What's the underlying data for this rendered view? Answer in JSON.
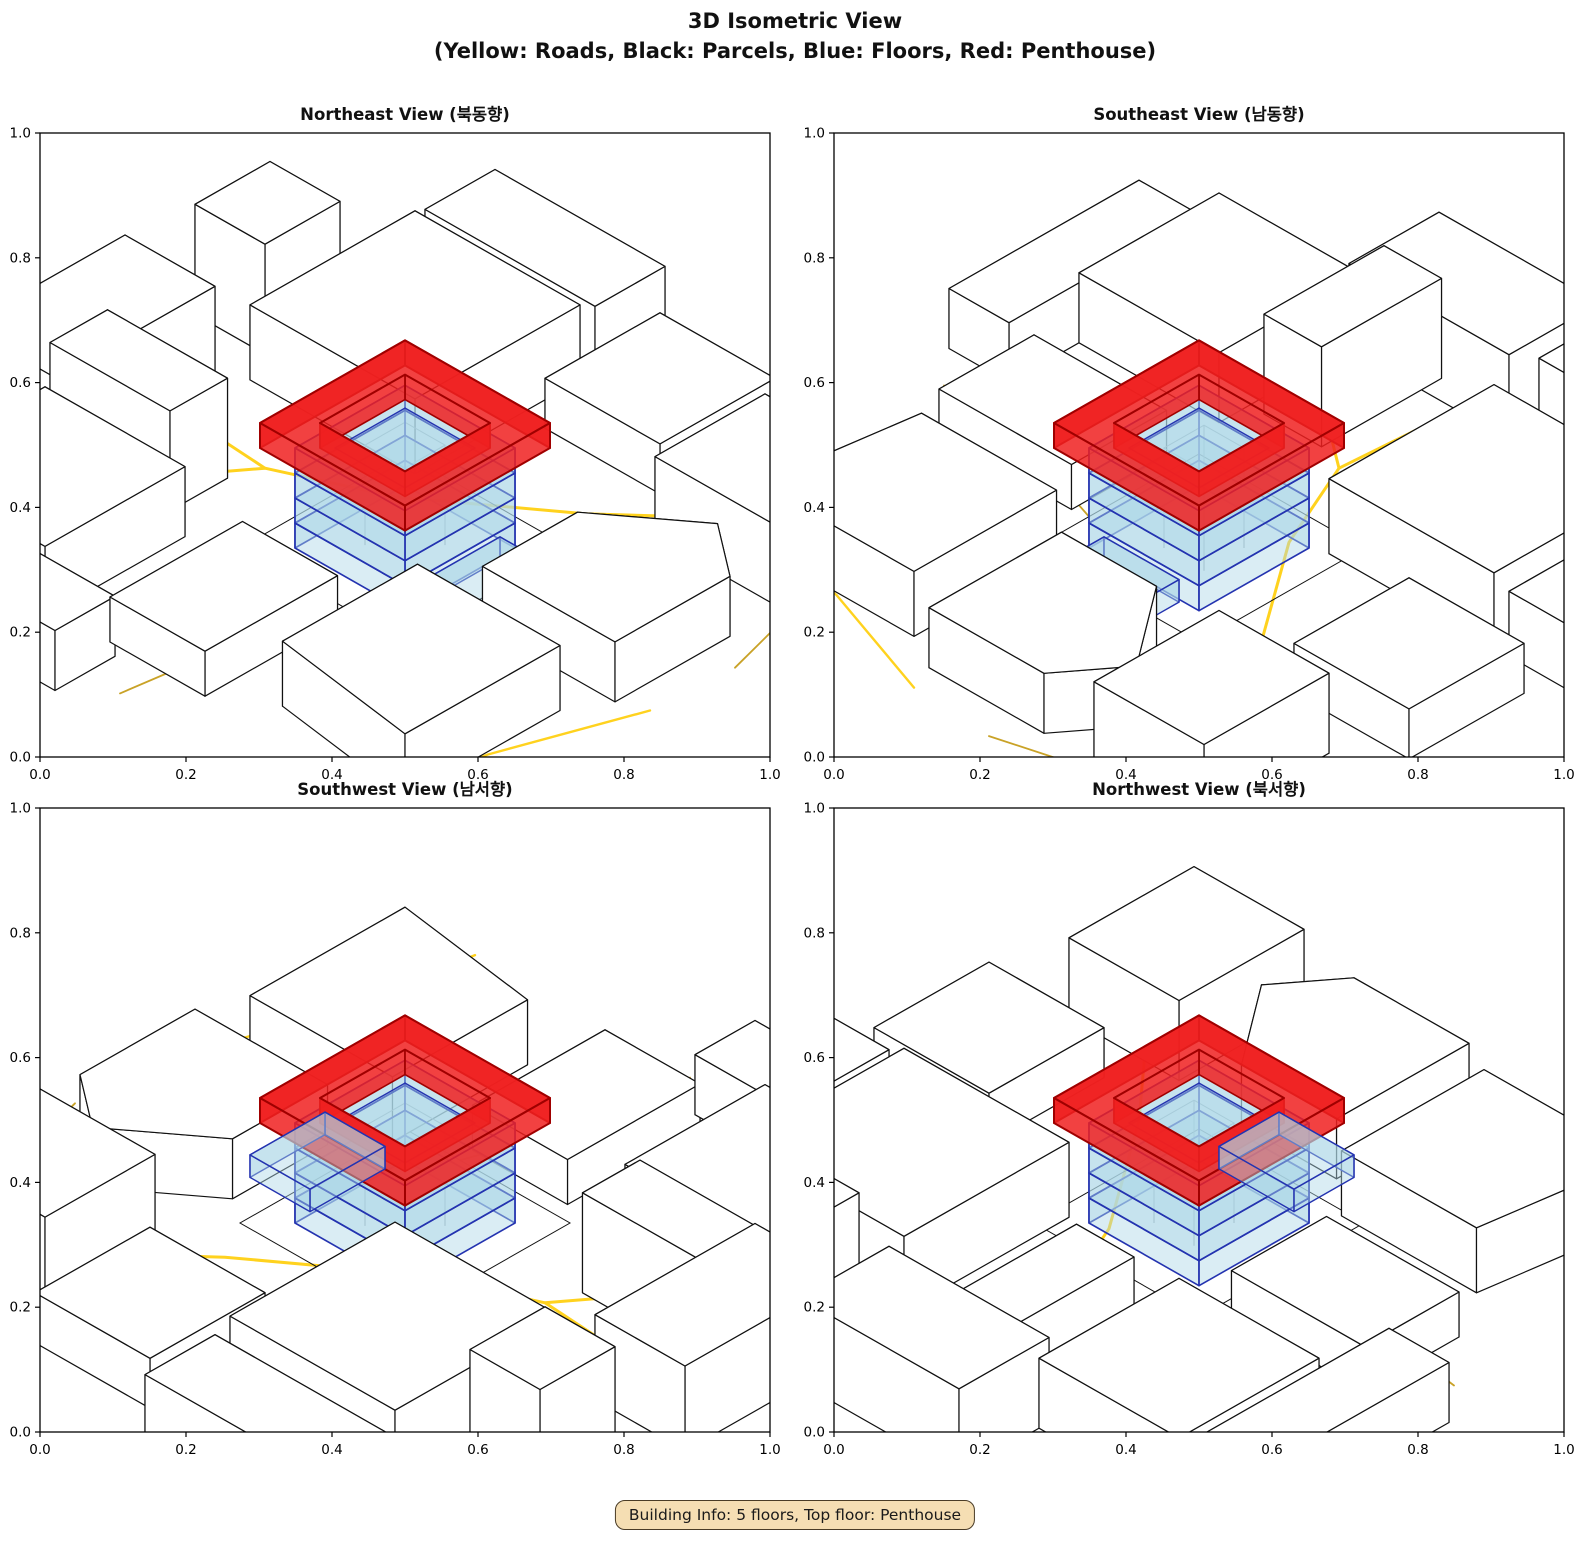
{
  "figure": {
    "title_line1": "3D Isometric View",
    "title_line2": "(Yellow: Roads, Black: Parcels, Blue: Floors, Red: Penthouse)",
    "annotation": "Building Info: 5 floors, Top floor: Penthouse"
  },
  "chart_data": {
    "type": "3d-isometric-city",
    "title": "3D Isometric View",
    "subtitle": "(Yellow: Roads, Black: Parcels, Blue: Floors, Red: Penthouse)",
    "annotation": "Building Info: 5 floors, Top floor: Penthouse",
    "views": [
      {
        "id": "northeast",
        "title": "Northeast View (북동향)",
        "azimuth_deg": 0
      },
      {
        "id": "southeast",
        "title": "Southeast View (남동향)",
        "azimuth_deg": 90
      },
      {
        "id": "southwest",
        "title": "Southwest View (남서향)",
        "azimuth_deg": 180
      },
      {
        "id": "northwest",
        "title": "Northwest View (북서향)",
        "azimuth_deg": 270
      }
    ],
    "axes": {
      "xlim": [
        0,
        1
      ],
      "ylim": [
        0,
        1
      ],
      "ticks": [
        0,
        0.2,
        0.4,
        0.6,
        0.8,
        1
      ],
      "tick_labels": [
        "0.0",
        "0.2",
        "0.4",
        "0.6",
        "0.8",
        "1.0"
      ],
      "grid": false
    },
    "legend_colors": {
      "roads": "#FFD21E",
      "parcels": "#000000",
      "floors": "#ADD8E6",
      "penthouse": "#F02020"
    },
    "building": {
      "floors": 5,
      "top_floor": "Penthouse",
      "floor_height": 0.05,
      "footprint": [
        0.39,
        0.39,
        0.61,
        0.61
      ],
      "penthouse_footprint": [
        0.355,
        0.355,
        0.645,
        0.645
      ],
      "penthouse_hole": [
        0.415,
        0.415,
        0.585,
        0.585
      ],
      "parapet": [
        0.43,
        0.43,
        0.57,
        0.57
      ],
      "core": [
        0.465,
        0.465,
        0.545,
        0.545
      ],
      "annex": [
        0.425,
        0.265,
        0.575,
        0.385
      ],
      "annex_height": 0.045,
      "floor_fill": "#ADD8E6",
      "floor_fill_opacity": 0.45,
      "floor_edge": "#2433B0",
      "core_edge": "#8a9096",
      "penthouse_fill": "#F02020",
      "penthouse_fill_opacity": 0.85,
      "penthouse_edge": "#A00000"
    },
    "scene": {
      "road_colors": {
        "gold": "#FFD21E",
        "dim": "#C9A227"
      },
      "roads": [
        {
          "pts": [
            [
              0.52,
              1.06
            ],
            [
              0.5,
              0.78
            ],
            [
              0.58,
              0.6
            ],
            [
              0.74,
              0.38
            ],
            [
              0.93,
              0.17
            ],
            [
              1.06,
              0.09
            ]
          ],
          "c": "gold",
          "w": 3
        },
        {
          "pts": [
            [
              0.5,
              0.78
            ],
            [
              0.3,
              0.93
            ],
            [
              0.1,
              1.04
            ]
          ],
          "c": "gold",
          "w": 3
        },
        {
          "pts": [
            [
              -0.04,
              0.53
            ],
            [
              0.17,
              0.5
            ],
            [
              0.335,
              0.445
            ]
          ],
          "c": "dim",
          "w": 1.8
        },
        {
          "pts": [
            [
              -0.04,
              0.1
            ],
            [
              0.22,
              0.055
            ],
            [
              0.46,
              -0.03
            ]
          ],
          "c": "gold",
          "w": 2.4
        },
        {
          "pts": [
            [
              0.62,
              -0.04
            ],
            [
              0.88,
              0.03
            ],
            [
              1.06,
              0.12
            ]
          ],
          "c": "dim",
          "w": 1.8
        }
      ],
      "parcels": [
        {
          "poly": [
            [
              0.02,
              0.74
            ],
            [
              0.3,
              0.74
            ],
            [
              0.3,
              1.02
            ],
            [
              0.02,
              1.02
            ]
          ],
          "h": 0.14
        },
        {
          "poly": [
            [
              0.33,
              0.8
            ],
            [
              0.445,
              0.8
            ],
            [
              0.445,
              1.04
            ],
            [
              0.33,
              1.04
            ]
          ],
          "h": 0.2
        },
        {
          "poly": [
            [
              0.3,
              1.0
            ],
            [
              0.62,
              1.0
            ],
            [
              0.62,
              1.18
            ],
            [
              0.3,
              1.18
            ]
          ],
          "h": 0.17
        },
        {
          "poly": [
            [
              0.64,
              0.62
            ],
            [
              0.97,
              0.62
            ],
            [
              0.97,
              0.95
            ],
            [
              0.64,
              0.95
            ]
          ],
          "h": 0.15
        },
        {
          "poly": [
            [
              0.7,
              0.98
            ],
            [
              0.85,
              0.98
            ],
            [
              0.85,
              1.12
            ],
            [
              0.7,
              1.12
            ]
          ],
          "h": 0.22
        },
        {
          "poly": [
            [
              0.85,
              0.34
            ],
            [
              1.08,
              0.34
            ],
            [
              1.08,
              0.57
            ],
            [
              0.85,
              0.57
            ]
          ],
          "h": 0.1
        },
        {
          "poly": [
            [
              0.04,
              0.44
            ],
            [
              0.305,
              0.44
            ],
            [
              0.305,
              0.63
            ],
            [
              0.04,
              0.63
            ]
          ],
          "h": 0.09
        },
        {
          "poly": [
            [
              0.06,
              0.06
            ],
            [
              0.37,
              0.06
            ],
            [
              0.37,
              0.345
            ],
            [
              0.1,
              0.345
            ]
          ],
          "h": 0.13
        },
        {
          "poly": [
            [
              0.44,
              0.02
            ],
            [
              0.67,
              0.02
            ],
            [
              0.75,
              0.125
            ],
            [
              0.63,
              0.285
            ],
            [
              0.44,
              0.285
            ]
          ],
          "h": 0.12
        },
        {
          "poly": [
            [
              0.77,
              0.02
            ],
            [
              0.99,
              0.02
            ],
            [
              0.99,
              0.27
            ],
            [
              0.77,
              0.27
            ]
          ],
          "h": 0.16
        },
        {
          "poly": [
            [
              -0.1,
              0.6
            ],
            [
              0.02,
              0.6
            ],
            [
              0.02,
              0.98
            ],
            [
              -0.1,
              0.98
            ]
          ],
          "h": 0.12
        },
        {
          "poly": [
            [
              1.0,
              0.62
            ],
            [
              1.14,
              0.62
            ],
            [
              1.14,
              0.96
            ],
            [
              1.0,
              0.96
            ]
          ],
          "h": 0.13
        }
      ],
      "ground_outlines": [
        {
          "poly": [
            [
              0.335,
              0.335
            ],
            [
              0.665,
              0.335
            ],
            [
              0.665,
              0.665
            ],
            [
              0.335,
              0.665
            ]
          ]
        }
      ]
    }
  },
  "style": {
    "parcel_edge": "#111111",
    "parcel_fill": "#ffffff",
    "axis_color": "#000000"
  }
}
